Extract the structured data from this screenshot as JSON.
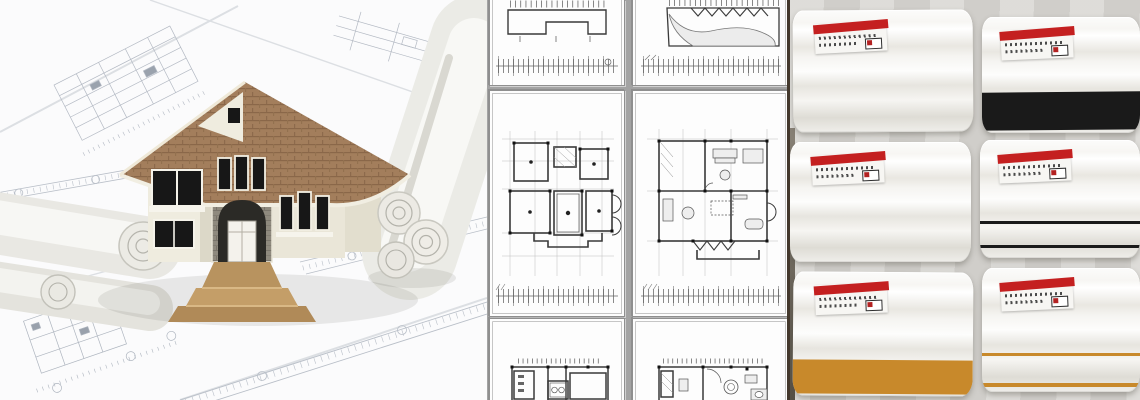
{
  "banner": {
    "width_px": 1140,
    "height_px": 400,
    "description": "Architectural design photo collage: 3D house model on blueprints, floor plan sheets, and molding product samples"
  },
  "panels": {
    "left": {
      "name": "house-model-on-blueprints",
      "description": "3D rendered two-story house model standing on spread and rolled architectural blueprint drawings",
      "colors": {
        "roof": "#a37e5c",
        "roof_line": "#8a6749",
        "wall": "#efecdf",
        "wall_shade": "#dcd8c8",
        "stone": "#8f8a7e",
        "stone_line": "#79746a",
        "window": "#171717",
        "window_frame": "#f2efe3",
        "steps": "#b8935f",
        "paper": "#f0efec",
        "line_work": "#b3b9c3"
      }
    },
    "middle": {
      "name": "floor-plan-sheet-grid",
      "description": "Six white architectural floor plan sheets arranged in a 2x3 grid on gray background; full plans in middle row, sheets cropped at top and bottom rows; each sheet has a dimension tick strip",
      "rows": 3,
      "cols": 2,
      "colors": {
        "background": "#a3a3a3",
        "sheet": "#fdfdfd",
        "wall_line": "#3a3a3a",
        "grid_line": "#bdbdbd",
        "column_marker": "#111111",
        "tick_line": "#555555"
      }
    },
    "right": {
      "name": "molding-sample-photos",
      "description": "Six white crown/skirting molding samples in a 2x3 grid, each with an upside-down red-banded product label; some have black or gold accent stripes",
      "rows": 3,
      "cols": 2,
      "colors": {
        "background": "#d8d6d2",
        "molding": "#f3f2ef",
        "label_red": "#c42020",
        "stripe_black": "#1a1a1a",
        "stripe_gold": "#c8892b"
      },
      "samples": [
        {
          "row": 1,
          "col": 1,
          "stripes": "none"
        },
        {
          "row": 1,
          "col": 2,
          "stripes": "wide-black-band-bottom"
        },
        {
          "row": 2,
          "col": 1,
          "stripes": "none"
        },
        {
          "row": 2,
          "col": 2,
          "stripes": "two-thin-black-lines"
        },
        {
          "row": 3,
          "col": 1,
          "stripes": "wide-gold-band-bottom"
        },
        {
          "row": 3,
          "col": 2,
          "stripes": "thin-gold-lines"
        }
      ]
    }
  }
}
